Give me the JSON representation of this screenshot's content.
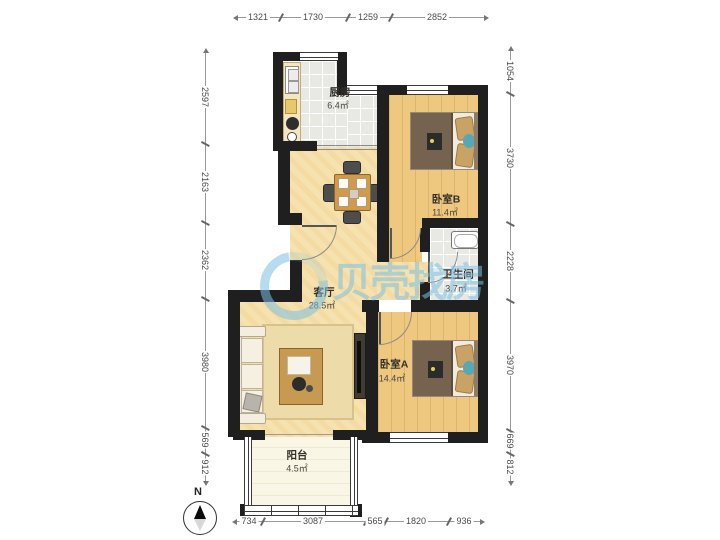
{
  "rooms": {
    "kitchen": {
      "name": "厨房",
      "area": "6.4㎡"
    },
    "bedroom_b": {
      "name": "卧室B",
      "area": "11.4㎡"
    },
    "bathroom": {
      "name": "卫生间",
      "area": "3.7㎡"
    },
    "living": {
      "name": "客厅",
      "area": "28.5㎡"
    },
    "bedroom_a": {
      "name": "卧室A",
      "area": "14.4㎡"
    },
    "balcony": {
      "name": "阳台",
      "area": "4.5㎡"
    }
  },
  "dimensions": {
    "top": [
      "1321",
      "1730",
      "1259",
      "2852"
    ],
    "left": [
      "2597",
      "2163",
      "2362",
      "3980",
      "569",
      "912"
    ],
    "right": [
      "1054",
      "3730",
      "2228",
      "3970",
      "669",
      "812"
    ],
    "bottom": [
      "734",
      "3087",
      "565",
      "1820",
      "936"
    ]
  },
  "watermark": {
    "text": "贝壳找房"
  },
  "compass": {
    "label": "N"
  },
  "colors": {
    "wall": "#1f1f1f",
    "floor_living": "#f6e2ae",
    "floor_bedroom": "#eec87f",
    "floor_tile": "#e9e9e4",
    "floor_balcony": "#faf6e6",
    "watermark_blue": "#7cbfe3"
  }
}
